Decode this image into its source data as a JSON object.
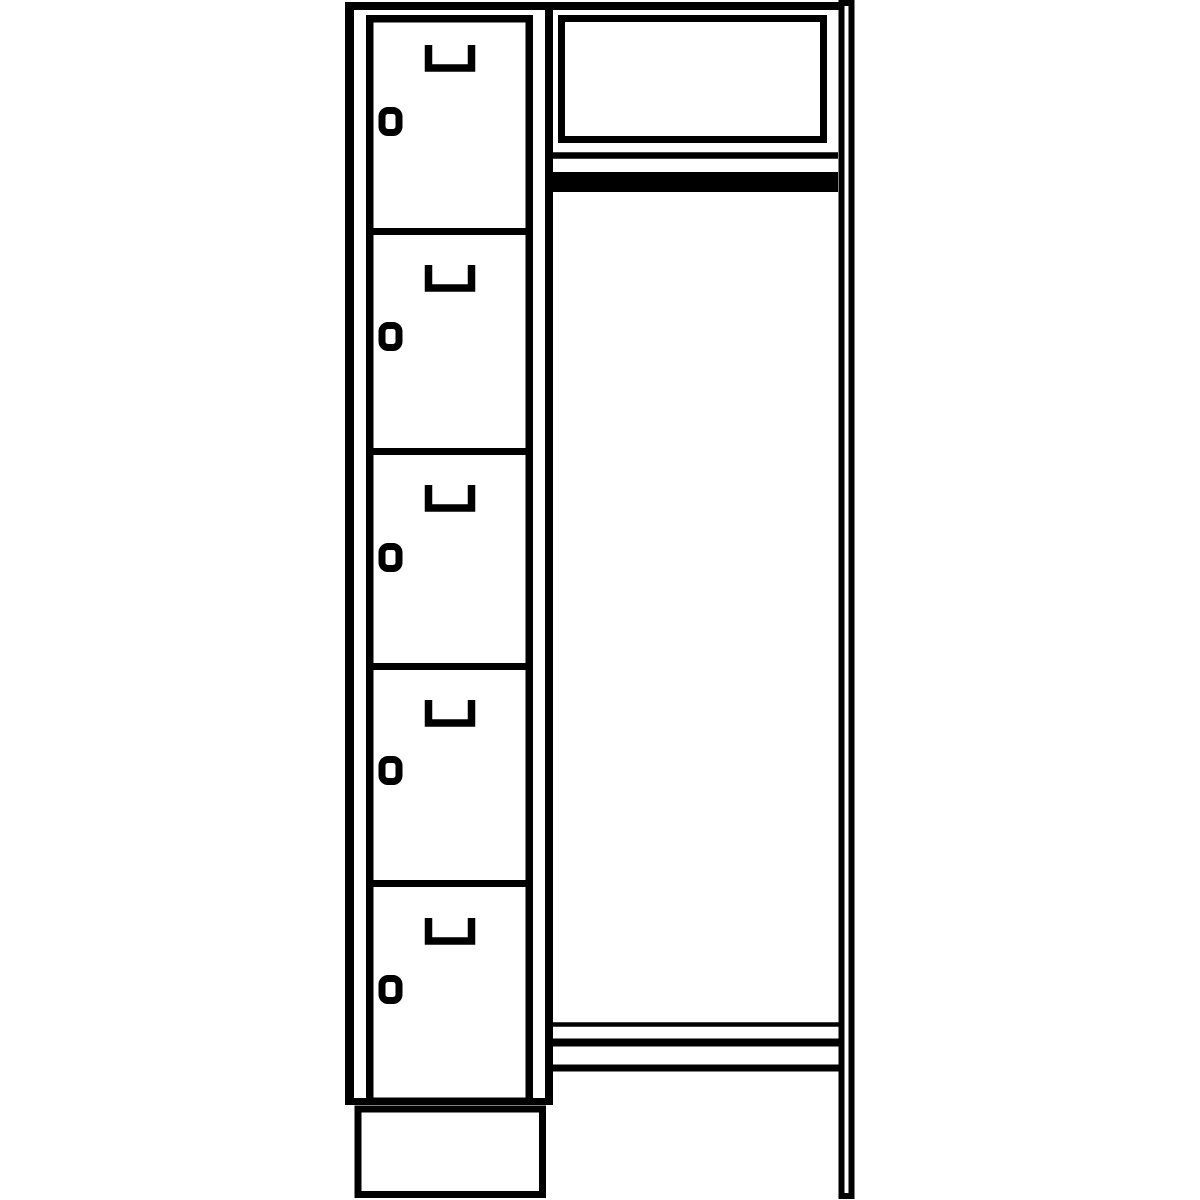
{
  "page": {
    "title": "Cloakroom locker unit with open wardrobe section — technical line drawing",
    "background_color": "#ffffff",
    "line_color": "#000000"
  },
  "diagram": {
    "type": "technical-line-drawing",
    "subject": "Five-compartment locker column beside an open coat section with hat shelf, clothes rail, bench rails, side frame leg and plinth base",
    "locker_column": {
      "compartment_count": 5,
      "doors": [
        {
          "id": 1,
          "top": 15,
          "handle_y": 45,
          "lock_y": 107
        },
        {
          "id": 2,
          "top": 228,
          "handle_y": 265,
          "lock_y": 322
        },
        {
          "id": 3,
          "top": 448,
          "handle_y": 485,
          "lock_y": 543
        },
        {
          "id": 4,
          "top": 663,
          "handle_y": 700,
          "lock_y": 756
        },
        {
          "id": 5,
          "top": 880,
          "handle_y": 918,
          "lock_y": 975
        }
      ]
    },
    "open_section": {
      "hat_shelf": true,
      "clothes_rail": true,
      "bench_rail_count": 3
    }
  }
}
